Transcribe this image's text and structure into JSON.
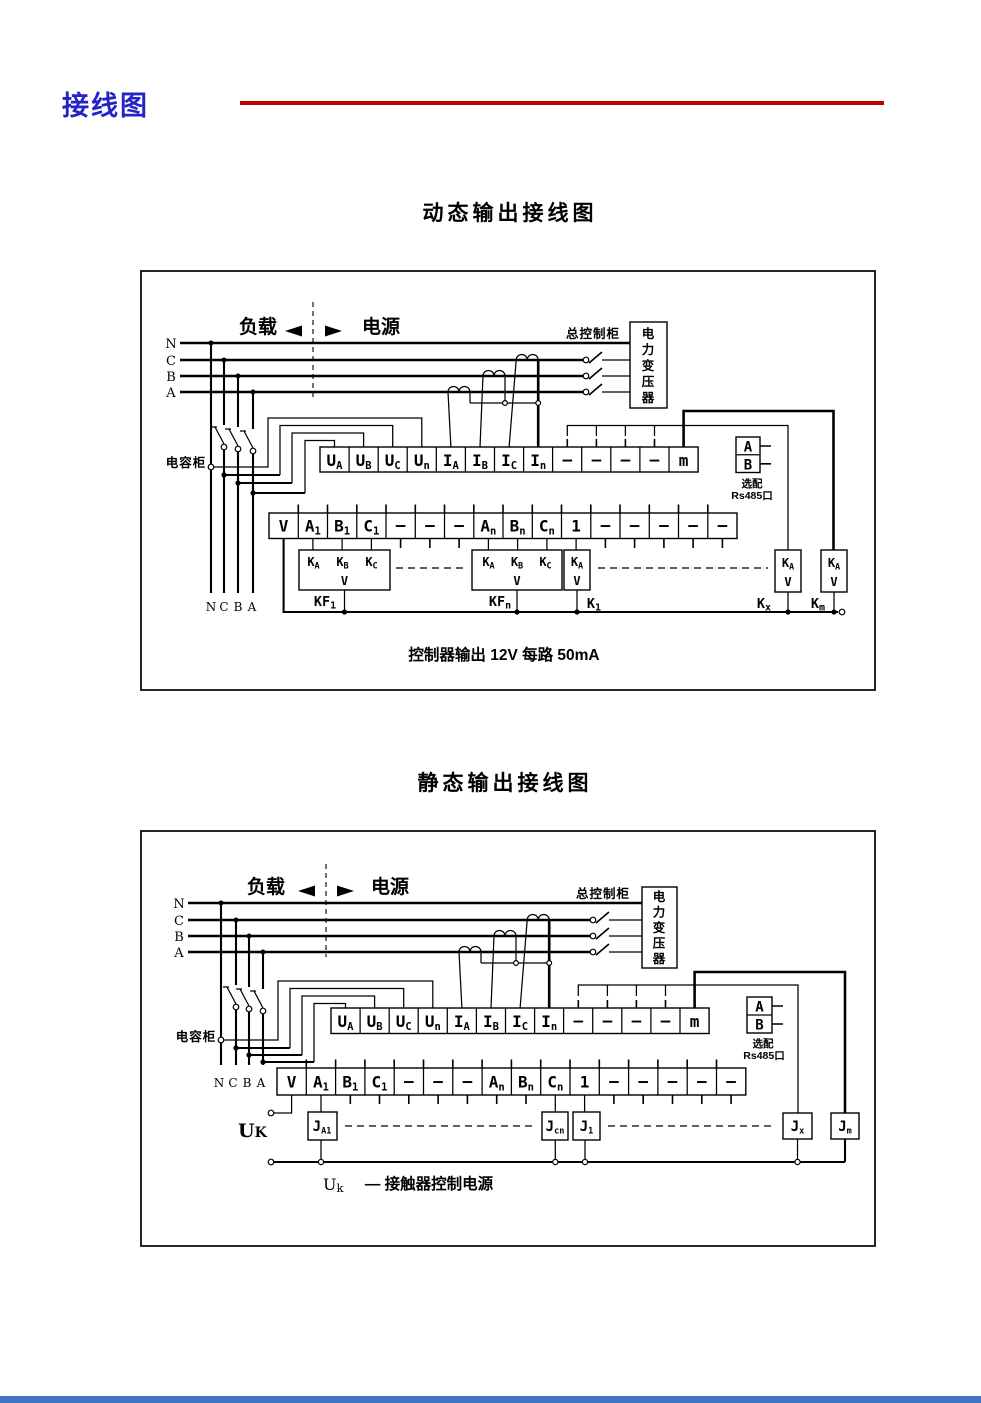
{
  "page": {
    "header_title": "接线图"
  },
  "colors": {
    "header_blue": "#2323c8",
    "rule_red": "#c00000",
    "footer_bar": "#4472c4",
    "ink": "#000000",
    "paper": "#ffffff"
  },
  "diagram1": {
    "title": "动态输出接线图",
    "load_label": "负载",
    "source_label": "电源",
    "cabinet_label": "总控制柜",
    "transformer_chars": [
      "电",
      "力",
      "变",
      "压",
      "器"
    ],
    "cap_cabinet_label": "电容柜",
    "phases": [
      "N",
      "C",
      "B",
      "A"
    ],
    "phases_bottom": [
      "N",
      "C",
      "B",
      "A"
    ],
    "rs485": {
      "a": "A",
      "b": "B",
      "opt": "选配",
      "port": "Rs485口"
    },
    "strip1": [
      {
        "m": "U",
        "s": "A"
      },
      {
        "m": "U",
        "s": "B"
      },
      {
        "m": "U",
        "s": "C"
      },
      {
        "m": "U",
        "s": "n"
      },
      {
        "m": "I",
        "s": "A"
      },
      {
        "m": "I",
        "s": "B"
      },
      {
        "m": "I",
        "s": "C"
      },
      {
        "m": "I",
        "s": "n"
      },
      {
        "m": "—"
      },
      {
        "m": "—"
      },
      {
        "m": "—"
      },
      {
        "m": "—"
      },
      {
        "m": "m"
      }
    ],
    "strip2": [
      {
        "m": "V"
      },
      {
        "m": "A",
        "s": "1"
      },
      {
        "m": "B",
        "s": "1"
      },
      {
        "m": "C",
        "s": "1"
      },
      {
        "m": "—"
      },
      {
        "m": "—"
      },
      {
        "m": "—"
      },
      {
        "m": "A",
        "s": "n"
      },
      {
        "m": "B",
        "s": "n"
      },
      {
        "m": "C",
        "s": "n"
      },
      {
        "m": "1"
      },
      {
        "m": "—"
      },
      {
        "m": "—"
      },
      {
        "m": "—"
      },
      {
        "m": "—"
      },
      {
        "m": "—"
      }
    ],
    "kf1": {
      "c1": {
        "m": "K",
        "s": "A"
      },
      "c2": {
        "m": "K",
        "s": "B"
      },
      "c3": {
        "m": "K",
        "s": "C"
      },
      "v": "V",
      "tag": {
        "m": "KF",
        "s": "1"
      }
    },
    "kfn": {
      "c1": {
        "m": "K",
        "s": "A"
      },
      "c2": {
        "m": "K",
        "s": "B"
      },
      "c3": {
        "m": "K",
        "s": "C"
      },
      "v": "V",
      "tag": {
        "m": "KF",
        "s": "n"
      }
    },
    "k1": {
      "c1": {
        "m": "K",
        "s": "A"
      },
      "v": "V",
      "tag": {
        "m": "K",
        "s": "1"
      }
    },
    "kx": {
      "c1": {
        "m": "K",
        "s": "A"
      },
      "v": "V",
      "tag": {
        "m": "K",
        "s": "x"
      }
    },
    "km": {
      "c1": {
        "m": "K",
        "s": "A"
      },
      "v": "V",
      "tag": {
        "m": "K",
        "s": "m"
      }
    },
    "caption": "控制器输出 12V 每路 50mA"
  },
  "diagram2": {
    "title": "静态输出接线图",
    "load_label": "负载",
    "source_label": "电源",
    "cabinet_label": "总控制柜",
    "transformer_chars": [
      "电",
      "力",
      "变",
      "压",
      "器"
    ],
    "cap_cabinet_label": "电容柜",
    "phases": [
      "N",
      "C",
      "B",
      "A"
    ],
    "phases_bottom": [
      "N",
      "C",
      "B",
      "A"
    ],
    "rs485": {
      "a": "A",
      "b": "B",
      "opt": "选配",
      "port": "Rs485口"
    },
    "strip1": [
      {
        "m": "U",
        "s": "A"
      },
      {
        "m": "U",
        "s": "B"
      },
      {
        "m": "U",
        "s": "C"
      },
      {
        "m": "U",
        "s": "n"
      },
      {
        "m": "I",
        "s": "A"
      },
      {
        "m": "I",
        "s": "B"
      },
      {
        "m": "I",
        "s": "C"
      },
      {
        "m": "I",
        "s": "n"
      },
      {
        "m": "—"
      },
      {
        "m": "—"
      },
      {
        "m": "—"
      },
      {
        "m": "—"
      },
      {
        "m": "m"
      }
    ],
    "strip2": [
      {
        "m": "V"
      },
      {
        "m": "A",
        "s": "1"
      },
      {
        "m": "B",
        "s": "1"
      },
      {
        "m": "C",
        "s": "1"
      },
      {
        "m": "—"
      },
      {
        "m": "—"
      },
      {
        "m": "—"
      },
      {
        "m": "A",
        "s": "n"
      },
      {
        "m": "B",
        "s": "n"
      },
      {
        "m": "C",
        "s": "n"
      },
      {
        "m": "1"
      },
      {
        "m": "—"
      },
      {
        "m": "—"
      },
      {
        "m": "—"
      },
      {
        "m": "—"
      },
      {
        "m": "—"
      }
    ],
    "uk": {
      "m": "U",
      "s": "K"
    },
    "ja1": {
      "m": "J",
      "s": "A1"
    },
    "jcn": {
      "m": "J",
      "s": "cn"
    },
    "j1": {
      "m": "J",
      "s": "1"
    },
    "jx": {
      "m": "J",
      "s": "x"
    },
    "jm": {
      "m": "J",
      "s": "m"
    },
    "caption_u": {
      "m": "U",
      "s": "k"
    },
    "caption_text": "— 接触器控制电源"
  }
}
